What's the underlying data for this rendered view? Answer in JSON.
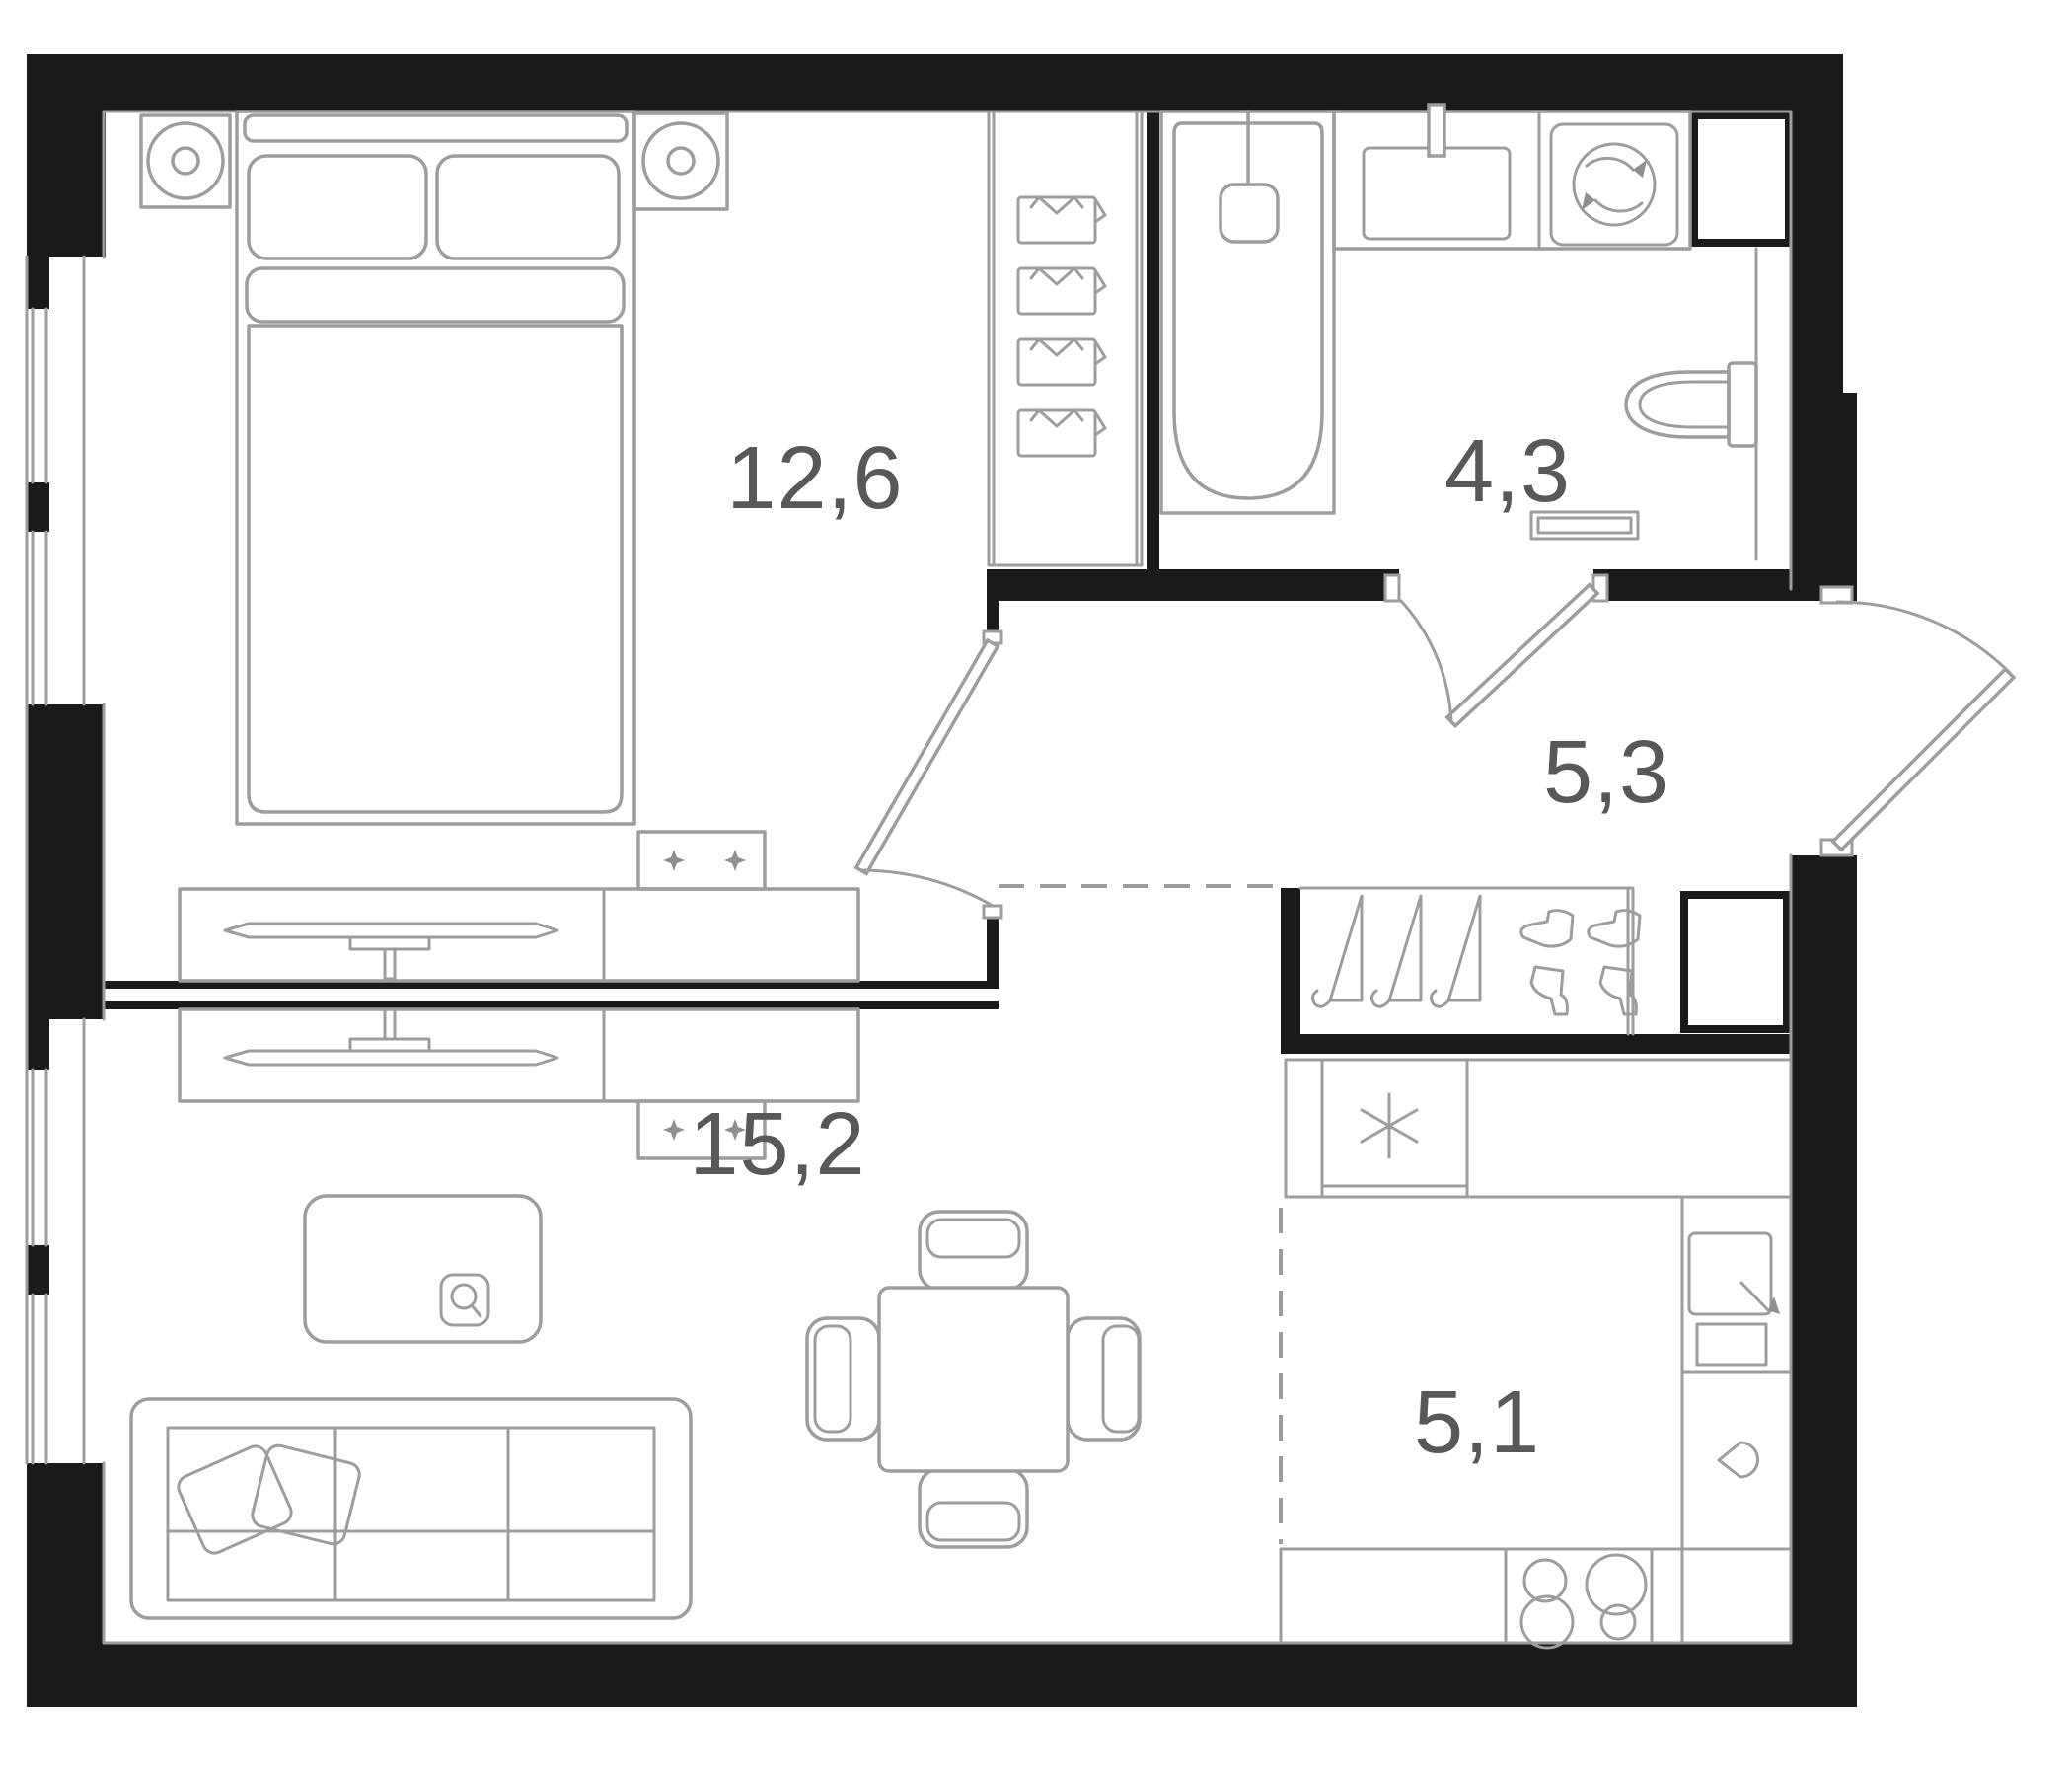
{
  "plan": {
    "type": "apartment-floor-plan",
    "background": "#ffffff",
    "colors": {
      "wall": "#1a1a1a",
      "furniture_line": "#9d9d9d",
      "label_text": "#57585a"
    },
    "rooms": [
      {
        "name": "bedroom",
        "area_label": "12,6"
      },
      {
        "name": "bathroom",
        "area_label": "4,3"
      },
      {
        "name": "hallway",
        "area_label": "5,3"
      },
      {
        "name": "living-room",
        "area_label": "15,2"
      },
      {
        "name": "kitchen",
        "area_label": "5,1"
      }
    ],
    "furniture": {
      "bedroom": [
        "nightstand-lamp-left",
        "double-bed",
        "pillows",
        "nightstand-lamp-right",
        "wardrobe-shirts",
        "tv-console",
        "wall-cabinet-sparkles"
      ],
      "bathroom": [
        "bathtub",
        "bath-faucet",
        "sink-counter",
        "washing-machine",
        "toilet",
        "towel-rail",
        "duct-shaft"
      ],
      "hallway": [
        "entrance-door",
        "coat-rack-hangers",
        "boots",
        "duct-shaft"
      ],
      "living-room": [
        "tv-console",
        "wall-cabinet-sparkles",
        "coffee-table",
        "sofa-3-seat",
        "sofa-pillows",
        "dining-table",
        "chairs"
      ],
      "kitchen": [
        "refrigerator-snowflake",
        "counter",
        "kitchen-sink",
        "dishwasher-drop",
        "stove-4-burners"
      ]
    },
    "doors": [
      "bedroom-door",
      "bathroom-door",
      "entrance-door"
    ],
    "windows": [
      "bedroom-window-1",
      "bedroom-window-2",
      "living-room-window-1",
      "living-room-window-2"
    ]
  }
}
